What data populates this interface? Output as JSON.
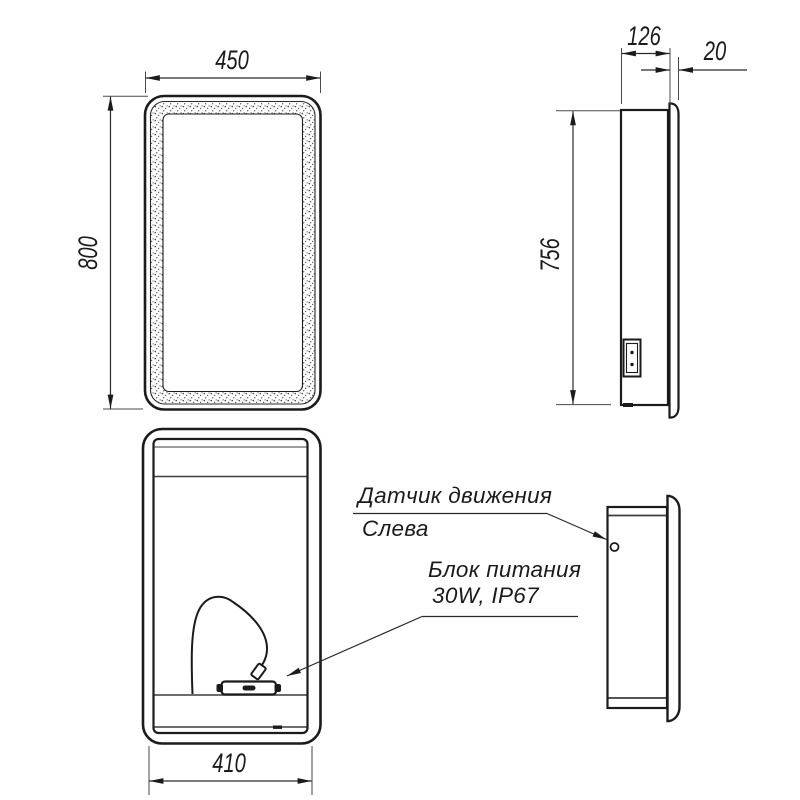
{
  "drawing": {
    "type": "technical-dimension-drawing",
    "subject": "mirror-cabinet",
    "background_color": "#ffffff",
    "line_color": "#1b1b1b",
    "views": {
      "front_closed": "front view with LED stipple frame",
      "side_top": "side section view with mounting plate",
      "front_open": "front view open with cable and power supply",
      "side_bottom": "side view with motion sensor"
    }
  },
  "dimensions": {
    "overall_width": "450",
    "overall_height": "800",
    "depth": "126",
    "mirror_overhang": "20",
    "body_height": "756",
    "inner_width": "410"
  },
  "annotations": {
    "motion_sensor_line1": "Датчик движения",
    "motion_sensor_line2": "Слева",
    "power_supply_line1": "Блок питания",
    "power_supply_line2": "30W, IP67"
  }
}
